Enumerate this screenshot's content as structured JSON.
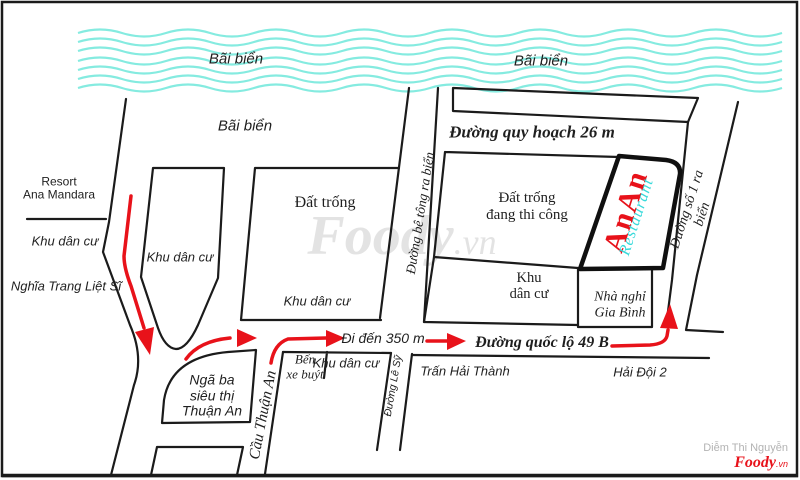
{
  "colors": {
    "wave": "#85EBE0",
    "ink": "#1B1B1B",
    "route_red": "#E8121A",
    "landmark_red": "#E8121A",
    "landmark_cyan": "#38D9DA",
    "watermark_gray": "#E0E0E0"
  },
  "beach": {
    "label_left": "Bãi biển",
    "label_mid": "Bãi biển",
    "label_right": "Bãi biển"
  },
  "roads": {
    "quy_hoach": "Đường quy hoạch 26 m",
    "be_tong": "Đường bê tông ra biển",
    "so_1": "Đường số 1 ra biển",
    "quoc_lo": "Đường quốc lộ 49 B",
    "cau_thuan_an": "Cầu Thuận An",
    "le_sy": "Đường Lê Sỹ"
  },
  "areas": {
    "resort": "Resort\nAna Mandara",
    "khu_dan_cu_west": "Khu dân cư",
    "nghia_trang": "Nghĩa Trang Liệt Sĩ",
    "khu_dan_cu_island": "Khu dân cư",
    "dat_trong": "Đất trống",
    "khu_dan_cu_center": "Khu dân cư",
    "dat_trong_thi_cong": "Đất trống\nđang thi công",
    "khu_dan_cu_east": "Khu\ndân cư",
    "nha_nghi": "Nhà nghỉ\nGia Bình",
    "nga_ba": "Ngã ba\nsiêu thị\nThuận An",
    "ben_xe_buyt": "Bến\nxe buýt",
    "khu_dan_cu_south": "Khu dân cư",
    "tran_hai_thanh": "Trấn Hải Thành",
    "hai_doi_2": "Hải Đội 2"
  },
  "route": {
    "distance_note": "Đi đến 350 m"
  },
  "landmark": {
    "name": "AnAn",
    "subtitle": "Restaurant"
  },
  "watermark": {
    "brand": "Foody",
    "suffix": ".vn"
  },
  "credit": {
    "author": "Diễm Thi Nguyễn",
    "brand": "Foody",
    "suffix": ".vn"
  }
}
